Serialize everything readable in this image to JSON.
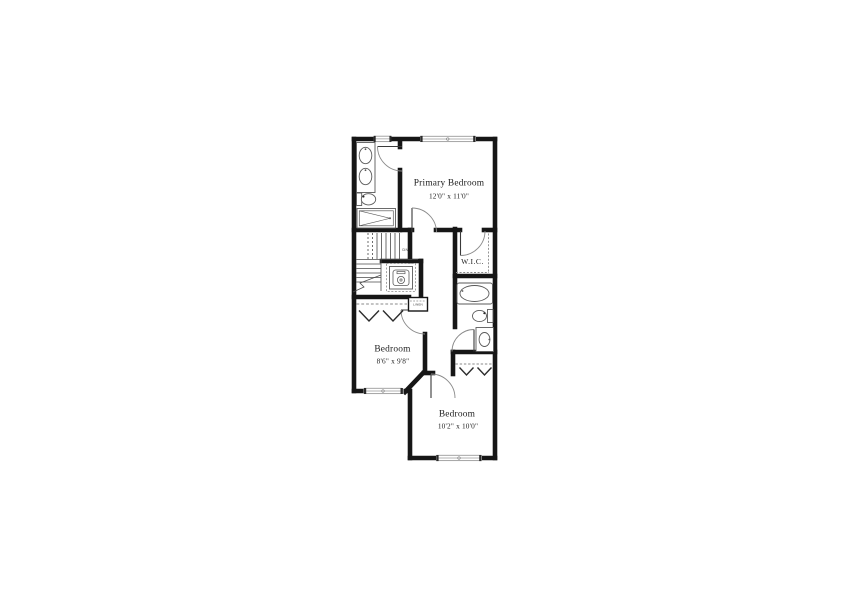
{
  "floor_plan": {
    "rooms": {
      "primary_bedroom": {
        "name": "Primary Bedroom",
        "dims": "12'0\" x 11'0\""
      },
      "bedroom_2": {
        "name": "Bedroom",
        "dims": "8'6\" x 9'8\""
      },
      "bedroom_3": {
        "name": "Bedroom",
        "dims": "10'2\" x 10'0\""
      },
      "wic": {
        "name": "W.I.C."
      },
      "linen": {
        "name": "LINEN"
      }
    },
    "stairs": {
      "label": "DN"
    },
    "symbols": {
      "fixtures": [
        "double-sink-vanity-icon",
        "toilet-icon",
        "shower-icon",
        "stacked-washer-dryer-icon",
        "bathtub-icon",
        "sink-vanity-icon"
      ],
      "closet": [
        "hanging-rod-chevron-icon",
        "shelf-dashed-line"
      ],
      "openings": [
        "window-symbol",
        "door-swing-arc"
      ]
    },
    "colors": {
      "wall": "#161616",
      "fixture_outline": "#5a5a5a",
      "dashed_line": "#8a8a8a",
      "window_frame": "#9a9a9a",
      "text": "#222222",
      "background": "#ffffff"
    }
  }
}
